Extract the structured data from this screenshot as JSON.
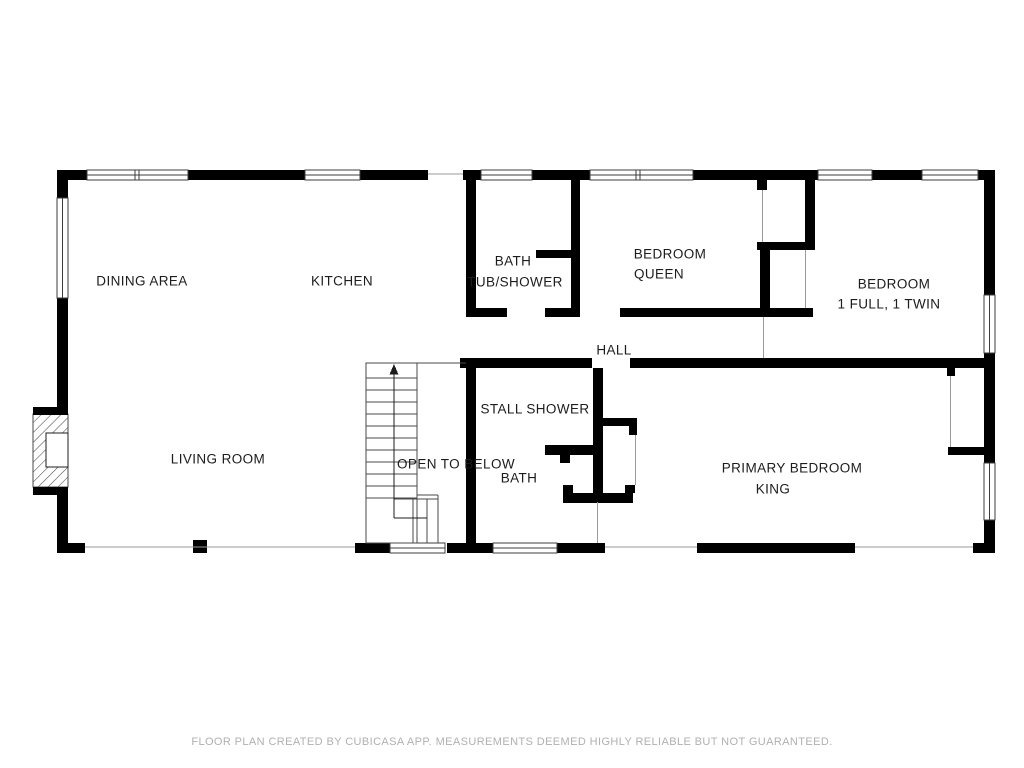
{
  "page": {
    "background": "#ffffff"
  },
  "palette": {
    "wall": "#000000",
    "window_outline": "#3c3c3c",
    "thin_edge": "#9a9a9a",
    "stair_line": "#4a4a4a",
    "label_text": "#1c1c1c",
    "footer_text": "#b0b0b0"
  },
  "rooms": {
    "dining_area": {
      "label": "DINING AREA"
    },
    "kitchen": {
      "label": "KITCHEN"
    },
    "bath_tub_shower": {
      "label": "BATH",
      "sublabel": "TUB/SHOWER"
    },
    "bedroom_queen": {
      "label": "BEDROOM",
      "sublabel": "QUEEN"
    },
    "bedroom_full_twin": {
      "label": "BEDROOM",
      "sublabel": "1 FULL, 1 TWIN"
    },
    "hall": {
      "label": "HALL"
    },
    "stall_shower": {
      "label": "STALL SHOWER"
    },
    "open_to_below": {
      "label": "OPEN TO BELOW"
    },
    "bath": {
      "label": "BATH"
    },
    "living_room": {
      "label": "LIVING ROOM"
    },
    "primary_bedroom": {
      "label": "PRIMARY BEDROOM",
      "sublabel": "KING"
    }
  },
  "icons": {
    "stairs_up_arrow": "up-arrow",
    "fireplace": "hatched-firebox-symbol",
    "window": "double-line-window-symbol"
  },
  "footer": {
    "disclaimer": "FLOOR PLAN CREATED BY CUBICASA APP. MEASUREMENTS DEEMED HIGHLY RELIABLE BUT NOT GUARANTEED."
  }
}
